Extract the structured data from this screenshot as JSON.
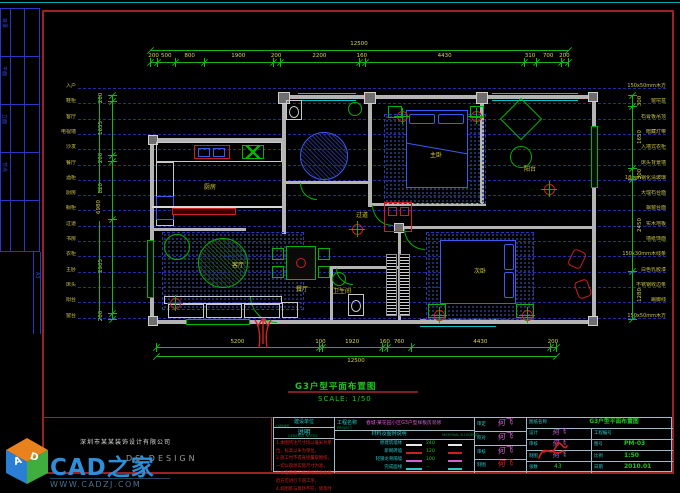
{
  "colors": {
    "background": "#000000",
    "frame": "#9b2222",
    "dimension": "#18b418",
    "dim_text": "#d8d44e",
    "projection": "#2833c2",
    "wall": "#b4b4b4",
    "cyan": "#2cc8c8",
    "green": "#1ec81e",
    "red": "#d42222",
    "magenta": "#d45fd4",
    "logo_blue": "#2e8fd8"
  },
  "sidebar": {
    "labels": [
      "目录",
      "平面",
      "立面",
      "节点"
    ],
    "strip_label": "A3"
  },
  "projection": {
    "left_labels": [
      "入户",
      "鞋柜",
      "客厅",
      "电视墙",
      "沙发",
      "餐厅",
      "酒柜",
      "厨房",
      "橱柜",
      "过道",
      "书房",
      "衣柜",
      "主卧",
      "床头",
      "阳台",
      "窗台"
    ],
    "right_labels": [
      "150x50mm木方",
      "窗帘盒",
      "石膏板吊顶",
      "暗藏灯带",
      "入墙式衣柜",
      "床头背景墙",
      "18mm钢化清玻璃",
      "大理石台面",
      "飘窗台面",
      "实木地板",
      "墙纸饰面",
      "150x30mm木线条",
      "白色乳胶漆",
      "不锈钢收边条",
      "踢脚线",
      "150x50mm木方"
    ]
  },
  "dims": {
    "top": {
      "total": "12500",
      "segments": [
        "200",
        "500",
        "800",
        "1900",
        "200",
        "2200",
        "160",
        "4430",
        "310",
        "700",
        "200"
      ]
    },
    "bottom": {
      "total": "12500",
      "segments": [
        "5200",
        "100",
        "1920",
        "160",
        "760",
        "4430",
        "200"
      ]
    },
    "left": {
      "total": "6980",
      "segments": [
        "200",
        "1655",
        "200",
        "1820",
        "2905",
        "200"
      ]
    },
    "right": {
      "segments": [
        "300",
        "1650",
        "300",
        "2450",
        "1280"
      ]
    }
  },
  "plan": {
    "rooms": [
      {
        "label": "厨房",
        "x": 204,
        "y": 184
      },
      {
        "label": "客厅",
        "x": 232,
        "y": 262
      },
      {
        "label": "餐厅",
        "x": 296,
        "y": 286
      },
      {
        "label": "主卧",
        "x": 430,
        "y": 152
      },
      {
        "label": "阳台",
        "x": 524,
        "y": 166
      },
      {
        "label": "次卧",
        "x": 474,
        "y": 268
      },
      {
        "label": "卫生间",
        "x": 333,
        "y": 288
      },
      {
        "label": "过道",
        "x": 356,
        "y": 212
      }
    ]
  },
  "plan_title": {
    "name": "G3户型平面布置图",
    "scale": "SCALE: 1/50"
  },
  "titleblock": {
    "client_label": "建设单位",
    "client_sub": "OWNER",
    "notes_title": "说明",
    "notes_sub": "GENERAL NOTES",
    "notes_lines": [
      "1.本图所注尺寸均以毫米为单位，标高以米为单位。",
      "2.施工时不得直接量取图纸，一切以现场实际尺寸为准。",
      "3.水电隐蔽工程须经验收合格后方可进行下道工序。",
      "4.如图纸与现场不符，请及时与设计师联系解决。"
    ],
    "project_label": "工程名称",
    "project_sub": "PROJECT",
    "project_name": "春城·某花园小区G3户型样板房装修",
    "legend_title": "材料及图例说明",
    "legend_sub": "MATERIAL & LEGEND",
    "legend_rows": [
      {
        "name": "原建筑墙体",
        "color": "#e8e8e8",
        "value": "240"
      },
      {
        "name": "新砌砖墙",
        "color": "#cc2020",
        "value": "120"
      },
      {
        "name": "轻钢龙骨隔墙",
        "color": "#d45fd4",
        "value": "100"
      },
      {
        "name": "完成面线",
        "color": "#2cc8c8",
        "value": "--"
      }
    ],
    "sig_rows": [
      {
        "label": "审定",
        "sig": "何飞"
      },
      {
        "label": "校对",
        "sig": "何飞"
      },
      {
        "label": "审核",
        "sig": "何飞"
      },
      {
        "label": "制图",
        "sig": "何飞"
      }
    ],
    "drawing_label": "图纸名称",
    "drawing_name": "G3户型平面布置图",
    "info_left": [
      {
        "label": "设计",
        "value": "何飞",
        "type": "sig"
      },
      {
        "label": "审核",
        "value": "何飞",
        "type": "sig"
      },
      {
        "label": "制图",
        "value": "何飞",
        "type": "sig"
      },
      {
        "label": "张数",
        "value": "43",
        "type": "val"
      }
    ],
    "info_right": [
      {
        "label": "工程编号",
        "value": ""
      },
      {
        "label": "图号",
        "value": "PM-03"
      },
      {
        "label": "比例",
        "value": "1:50"
      },
      {
        "label": "日期",
        "value": "2010.01"
      }
    ]
  },
  "footer": {
    "company": "深圳市某某装饰设计有限公司",
    "studio": "DS DESIGN",
    "logo_part1": "CAD",
    "logo_part2": "之家",
    "letter_a": "A",
    "letter_d": "D",
    "website": "WWW.CADZJ.COM"
  }
}
